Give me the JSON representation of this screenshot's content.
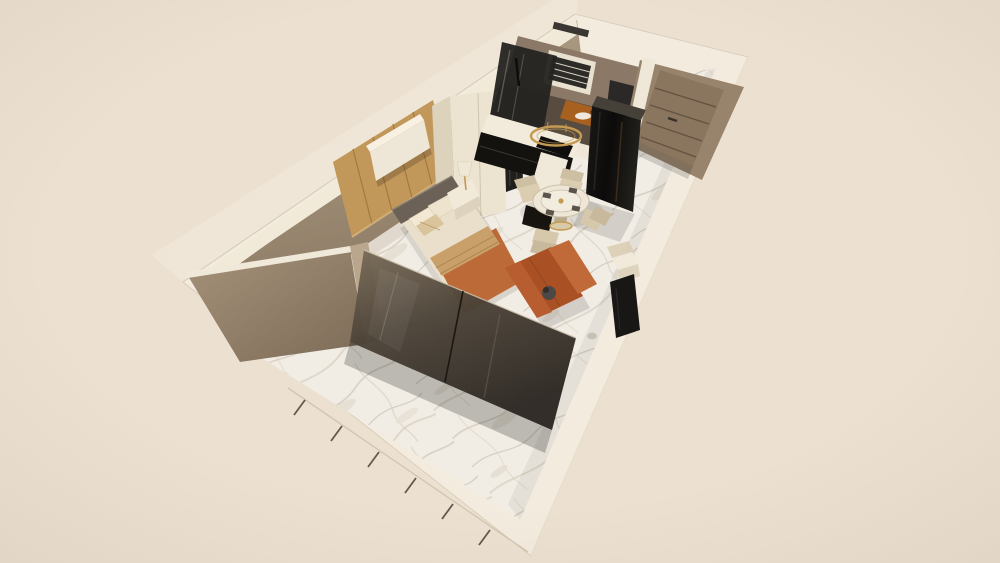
{
  "scene": {
    "type": "3d-apartment-dollhouse-render",
    "view": "axonometric top-down cutaway",
    "rooms": [
      {
        "name": "entry"
      },
      {
        "name": "bathroom"
      },
      {
        "name": "kitchen"
      },
      {
        "name": "dining-area"
      },
      {
        "name": "sleeping-area"
      },
      {
        "name": "terrace-living-area"
      }
    ],
    "objects": [
      {
        "name": "entry-door",
        "desc": "taupe door with horizontal grooves"
      },
      {
        "name": "bathroom-window",
        "desc": "white frame with dark louvers"
      },
      {
        "name": "shower-enclosure",
        "desc": "smoked glass"
      },
      {
        "name": "wood-vanity",
        "desc": "orange wood counter with white sink"
      },
      {
        "name": "refrigerator",
        "desc": "tall glossy black column"
      },
      {
        "name": "kitchen-counter",
        "desc": "L-shaped, white top, black base"
      },
      {
        "name": "cooktop",
        "desc": "black glass"
      },
      {
        "name": "ring-pendant-light",
        "desc": "gold circular pendant"
      },
      {
        "name": "wardrobe",
        "desc": "cream cabinet with smoked mirror door"
      },
      {
        "name": "round-dining-table",
        "desc": "marble top, gold base"
      },
      {
        "name": "dining-chairs",
        "count": 4,
        "desc": "cream upholstered"
      },
      {
        "name": "wood-accent-wall",
        "desc": "vertical tan wood paneling"
      },
      {
        "name": "floating-tv-cabinet",
        "desc": "white wall-hung unit"
      },
      {
        "name": "bed",
        "desc": "cream linens, gray headboard, tan and orange throws"
      },
      {
        "name": "nightstand-with-lamp"
      },
      {
        "name": "sofa",
        "desc": "rust orange loveseat"
      },
      {
        "name": "tv-panel",
        "desc": "dark screen near side wall"
      },
      {
        "name": "side-table",
        "desc": "white cube"
      },
      {
        "name": "glass-partition",
        "desc": "smoked glass wall at bed foot"
      },
      {
        "name": "glass-balustrade",
        "desc": "low wall with glass joints along terrace edge"
      },
      {
        "name": "marble-floor",
        "desc": "white marble with gray veining"
      }
    ]
  },
  "colors": {
    "background": "#ece1d1",
    "shell": "#f3ebde",
    "shell_outer": "#efe6d7",
    "edge": "#d7cab6",
    "wall_taupe": "#a28d75",
    "wall_taupe_dark": "#7f6e5a",
    "wood_panel": "#c2975a",
    "wood_panel_dark": "#a47a3c",
    "marble_base": "#f1ece4",
    "marble_vein": "#cfc7b8",
    "glass_dark": "#3b352d",
    "glossy_black": "#0f0e0d",
    "cream_furniture": "#eee6d6",
    "linen": "#eadfca",
    "headboard": "#6b6156",
    "blanket_orange": "#bc6a38",
    "sofa_orange": "#aa5025",
    "sofa_back_orange": "#c06a39",
    "throw_tan": "#caa06a",
    "gold": "#c49a52",
    "door": "#8a755e",
    "door_wall": "#98846d",
    "door_groove": "#5a4c3c",
    "chair": "#d8cab0",
    "chair_shade": "#c8b99c",
    "tv_dark": "#191715",
    "bathroom_wall": "#8b7866",
    "bathroom_floor": "#584c40",
    "shower_glass": "#242321",
    "vanity_wood": "#a8601f"
  }
}
